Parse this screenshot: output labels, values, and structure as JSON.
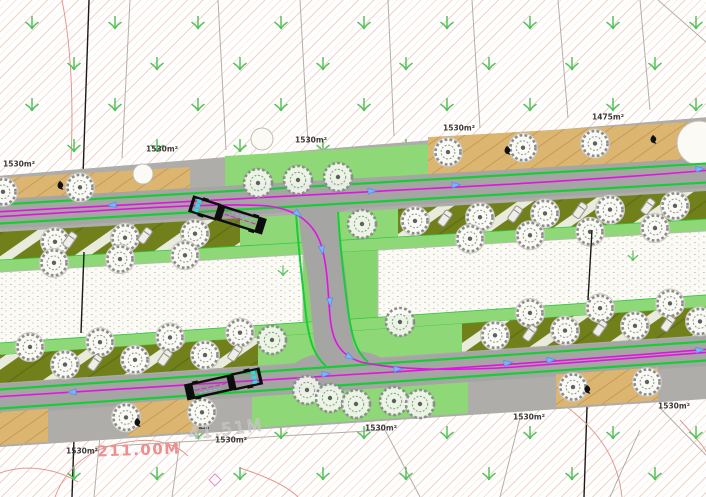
{
  "meta": {
    "type": "cad-site-plan",
    "description": "Boulevard site plan with bus swept-path analysis, parallel tree-lined roads, angled parking bays and plot area labels"
  },
  "colors": {
    "road": "#a5a5a3",
    "curb": "#aeada9",
    "tan": "#dcb570",
    "tan_hatch": "#b48c49",
    "olive": "#71801a",
    "olive_stripe": "#eff0e6",
    "verge": "#8fd878",
    "verge_dark": "#86d46e",
    "block": "#fbfaf5",
    "block_edge": "#b9beb3",
    "cycle_green": "#17cd35",
    "magenta": "#e312e3",
    "arrow_blue": "#7fb2ff",
    "arrow_blue_dark": "#4b86e8",
    "tree_stroke": "#8d8d8d",
    "tree_pad": "#f6f5f0",
    "label": "#3a3a3a",
    "dim_pink": "#ee8f8f",
    "dim_ghost": "#c6c6c6",
    "contour": "#e3988f",
    "parcel": "#b3afa8",
    "boundary": "#1a1a1a",
    "bus_black": "#0d0d0d",
    "bus_cyan": "#35d6e8",
    "car_fill": "#eeede7",
    "car_stroke": "#99988f",
    "bg_tree": "#55c35c"
  },
  "plan": {
    "top_line": {
      "y0": 214,
      "slope": -0.058
    },
    "bottom_line": {
      "y0": 399,
      "slope": -0.068
    },
    "corridor_offsets": {
      "top_left": -38,
      "top_right": -56,
      "bottom": 48
    },
    "area_labels": [
      {
        "text": "1530m²",
        "x": 19,
        "y": 164
      },
      {
        "text": "1530m²",
        "x": 162,
        "y": 149
      },
      {
        "text": "1530m²",
        "x": 311,
        "y": 140
      },
      {
        "text": "1530m²",
        "x": 459,
        "y": 128
      },
      {
        "text": "1475m²",
        "x": 608,
        "y": 117
      },
      {
        "text": "1530m²",
        "x": 82,
        "y": 451
      },
      {
        "text": "1530m²",
        "x": 231,
        "y": 440
      },
      {
        "text": "1530m²",
        "x": 381,
        "y": 428
      },
      {
        "text": "1530m²",
        "x": 529,
        "y": 417
      },
      {
        "text": "1530m²",
        "x": 674,
        "y": 406
      }
    ],
    "dimensions": [
      {
        "text": "211.00M",
        "x": 139,
        "y": 450,
        "style": "pink"
      },
      {
        "text": "41.51M",
        "x": 226,
        "y": 430,
        "style": "ghost"
      }
    ],
    "tan_top_segments": [
      [
        -10,
        190,
        -36,
        -12
      ],
      [
        428,
        716,
        -52,
        -14
      ]
    ],
    "tan_bottom_segments": [
      [
        -10,
        48,
        13,
        46
      ],
      [
        128,
        198,
        13,
        46
      ],
      [
        556,
        658,
        13,
        46
      ]
    ],
    "olive_top_segments": [
      [
        -10,
        240
      ],
      [
        398,
        716
      ]
    ],
    "olive_bottom_segments": [
      [
        -10,
        258
      ],
      [
        462,
        716
      ]
    ],
    "band_offsets": {
      "road_half": 15,
      "cycle": 9.5,
      "olive_top": [
        18,
        46
      ],
      "strip_top": [
        46,
        58
      ],
      "strip_bottom": [
        -56,
        -44
      ],
      "olive_bottom": [
        -44,
        -16
      ]
    },
    "blocks": {
      "left": [
        -10,
        303
      ],
      "right": [
        378,
        716
      ],
      "top_off": 58,
      "bottom_off": -56
    },
    "verges": {
      "top_junction": [
        225,
        430,
        -45,
        -13
      ],
      "bottom_junction": [
        252,
        468,
        15,
        46
      ]
    },
    "connector": {
      "road": "M 317 182 C 316 215 320 240 325 265 C 329 288 330 310 332 330 C 334 352 339 364 352 371",
      "flares": [
        [
          317,
          200,
          45,
          15,
          -3
        ],
        [
          338,
          365,
          45,
          14,
          -4
        ]
      ],
      "green_left": "M 296 212 C 298 245 302 280 306 315 C 309 340 314 356 326 366",
      "green_right": "M 338 212 C 340 245 344 280 348 310 C 352 338 356 352 368 362"
    },
    "routes": {
      "r1": "M -6 212 C 150 203 300 195 420 189 C 540 183 630 177 712 170",
      "r2": "M -6 217 C 110 210 220 202 268 206 C 300 210 316 226 322 248 C 328 270 328 295 330 316 C 332 340 339 355 361 362 C 395 370 455 371 515 367 C 600 361 665 356 712 352",
      "r3": "M -6 397 C 120 389 240 381 360 374 C 480 367 600 358 712 349"
    },
    "route_arrows": [
      [
        112,
        205,
        177
      ],
      [
        372,
        191,
        -3
      ],
      [
        456,
        185,
        -3
      ],
      [
        700,
        169,
        -3
      ],
      [
        298,
        214,
        40
      ],
      [
        322,
        250,
        82
      ],
      [
        330,
        302,
        85
      ],
      [
        350,
        357,
        28
      ],
      [
        72,
        392,
        177
      ],
      [
        326,
        374,
        -5
      ],
      [
        398,
        369,
        -4
      ],
      [
        508,
        363,
        -4
      ],
      [
        551,
        360,
        -4
      ],
      [
        700,
        350,
        -4
      ]
    ],
    "trees": {
      "tan_top": {
        "xs": [
          3,
          80,
          448,
          523,
          595
        ],
        "off": [
          -22,
          -22,
          -36,
          -36,
          -36
        ],
        "line": "t",
        "pad": true
      },
      "olive_top": {
        "xs": [
          55,
          125,
          195,
          415,
          480,
          545,
          610,
          675
        ],
        "off": 31,
        "line": "t",
        "pad": true
      },
      "strip_top": {
        "xs": [
          54,
          120,
          185,
          470,
          530,
          590,
          655
        ],
        "off": 52,
        "line": "t",
        "pad": true
      },
      "strip_bottom": {
        "xs": [
          30,
          100,
          170,
          240,
          530,
          600,
          670
        ],
        "off": -50,
        "line": "b",
        "pad": true
      },
      "olive_bottom": {
        "xs": [
          65,
          135,
          205,
          495,
          565,
          635,
          700
        ],
        "off": -30,
        "line": "b",
        "pad": true
      },
      "tan_bottom": {
        "xs": [
          126,
          202,
          573,
          647
        ],
        "off": 27,
        "line": "b",
        "pad": true
      },
      "junction_pts": [
        [
          258,
          183
        ],
        [
          298,
          180
        ],
        [
          338,
          177
        ],
        [
          272,
          340
        ],
        [
          362,
          224
        ],
        [
          400,
          322
        ],
        [
          307,
          390
        ],
        [
          330,
          398
        ],
        [
          356,
          404
        ],
        [
          394,
          401
        ],
        [
          420,
          404
        ]
      ]
    },
    "cars": {
      "olive_top": {
        "xs": [
          70,
          145,
          445,
          515,
          580,
          648
        ],
        "off": 30,
        "line": "t",
        "angle": -55
      },
      "olive_bottom": {
        "xs": [
          95,
          165,
          235,
          530,
          600,
          668
        ],
        "off": -30,
        "line": "b",
        "angle": -55
      }
    },
    "birds": [
      [
        60,
        185
      ],
      [
        507,
        150
      ],
      [
        653,
        139
      ],
      [
        137,
        422
      ],
      [
        587,
        389
      ]
    ],
    "caps": [
      [
        143,
        174,
        10
      ],
      [
        262,
        139,
        11
      ],
      [
        699,
        143,
        22
      ]
    ],
    "block_arrows": [
      [
        283,
        271
      ],
      [
        633,
        256
      ]
    ],
    "buses": [
      {
        "x": 227,
        "y": 215,
        "angle": 197.5
      },
      {
        "x": 224,
        "y": 384,
        "angle": -12.5
      }
    ],
    "bg": {
      "grid": {
        "x0": 32,
        "y0": 23,
        "dx": 83,
        "dy": 41,
        "row_offset": 42,
        "rows": 12
      },
      "parcels": [
        [
          130,
          0,
          122,
          158
        ],
        [
          218,
          0,
          226,
          150
        ],
        [
          300,
          0,
          308,
          143
        ],
        [
          388,
          0,
          394,
          136
        ],
        [
          472,
          0,
          480,
          128
        ],
        [
          558,
          0,
          568,
          118
        ],
        [
          640,
          0,
          650,
          110
        ],
        [
          658,
          0,
          706,
          42
        ],
        [
          100,
          436,
          94,
          497
        ],
        [
          180,
          441,
          172,
          497
        ],
        [
          95,
          447,
          385,
          430
        ],
        [
          385,
          430,
          420,
          497
        ],
        [
          520,
          418,
          500,
          497
        ],
        [
          660,
          408,
          706,
          455
        ],
        [
          640,
          430,
          610,
          497
        ]
      ],
      "boundaries": [
        [
          89,
          0,
          72,
          497
        ],
        [
          593,
          228,
          584,
          497
        ]
      ],
      "boundary_overlays": [
        [
          84,
          252,
          81,
          333
        ],
        [
          592,
          230,
          588,
          300
        ]
      ],
      "contours": [
        "M 55 497 C 70 458 100 445 135 441 C 160 438 178 446 188 456",
        "M 0 473 C 25 464 55 468 78 482",
        "M 613 235 C 603 258 596 280 589 299",
        "M 560 402 C 600 430 618 460 622 497",
        "M 240 468 C 268 477 288 487 298 497",
        "M 680 420 C 700 442 706 450 706 452",
        "M 62 0 C 70 40 74 90 71 160"
      ],
      "diamond": [
        215,
        480,
        6
      ],
      "tick": [
        199,
        428,
        209,
        428
      ]
    }
  }
}
